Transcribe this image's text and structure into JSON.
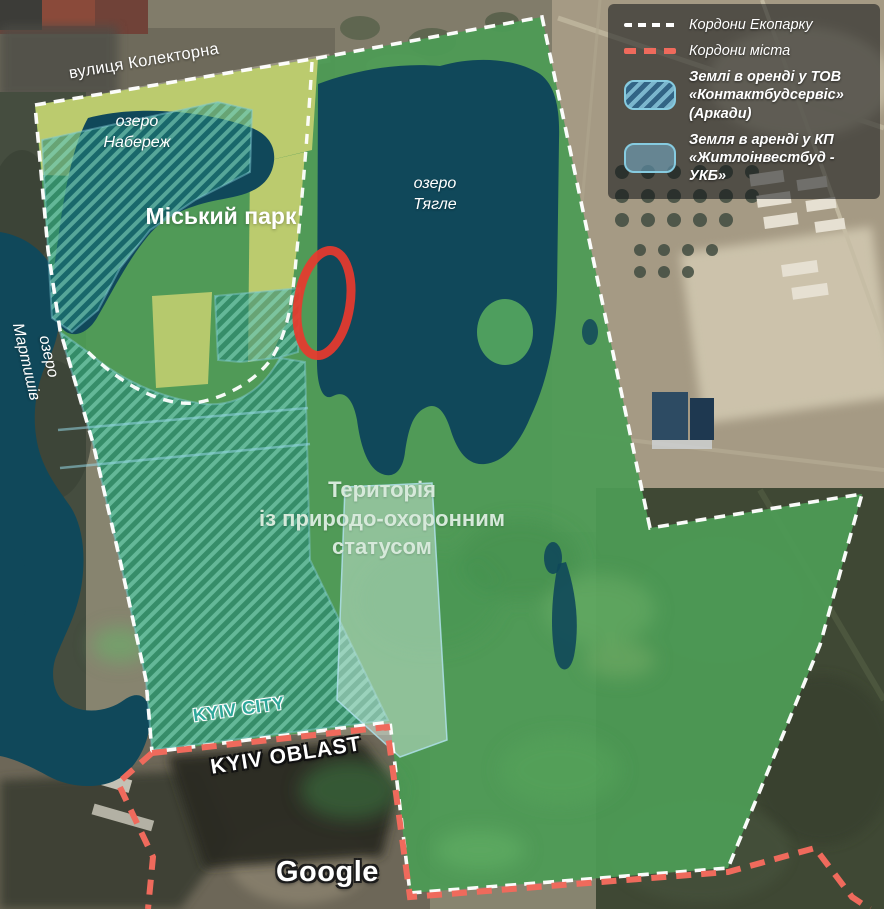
{
  "map_labels": {
    "street": "вулиця Колекторна",
    "lake_naberezh": {
      "line1": "озеро",
      "line2": "Набереж"
    },
    "city_park": "Міський парк",
    "lake_tiahle": {
      "line1": "озеро",
      "line2": "Тягле"
    },
    "lake_martyshiv": {
      "line1": "озеро",
      "line2": "Мартишів"
    },
    "protected_area": {
      "line1": "Територія",
      "line2": "із природо-охоронним",
      "line3": "статусом"
    },
    "kyiv_city": "KYIV CITY",
    "kyiv_oblast": "KYIV OBLAST",
    "watermark": "Google"
  },
  "legend": {
    "ecopark_border_label": "Кордони Екопарку",
    "city_border_label": "Кордони міста",
    "lease_kontakt": {
      "line1": "Землі в оренді у ТОВ",
      "line2": "«Контактбудсервіс» (Аркади)"
    },
    "lease_zhytlo": {
      "line1": "Земля в аренді у КП",
      "line2": "«Житлоінвестбуд - УКБ»"
    }
  },
  "colors": {
    "ecopark_green": "#4d9b55",
    "lake_teal": "#10485a",
    "hatch_teal": "#2f8773",
    "park_yellow": "#c1ce70",
    "ecopark_border_white": "#ffffff",
    "city_border_salmon": "#ef6a5c",
    "highlight_red": "#e8392e",
    "kyiv_city_teal": "#2fa89b",
    "legend_background": "rgba(14,19,22,0.55)"
  }
}
